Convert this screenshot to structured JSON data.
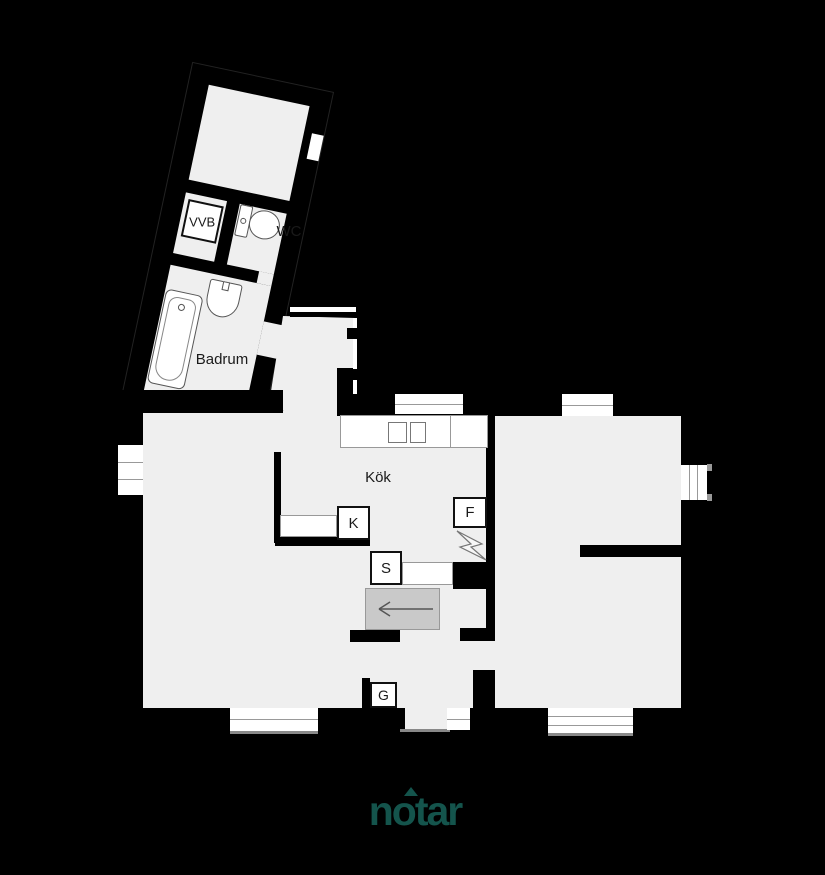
{
  "floorplan": {
    "room_labels": {
      "badrum": "Badrum",
      "kok": "Kök",
      "wc": "WC"
    },
    "marker_labels": {
      "vvb": "VVB",
      "kyl": "K",
      "frys": "F",
      "spis": "S",
      "garderob": "G"
    },
    "colors": {
      "background": "#000000",
      "floor": "#efefef",
      "wall": "#000000",
      "fixtures": "#ffffff",
      "stairs": "#c9c9c9",
      "logo": "#14544c"
    },
    "icons": [
      "bathtub-icon",
      "sink-icon",
      "toilet-icon",
      "stove-icon",
      "stairs-arrow-icon",
      "electric-zigzag-icon"
    ]
  },
  "branding": {
    "logo_text": "notar"
  }
}
